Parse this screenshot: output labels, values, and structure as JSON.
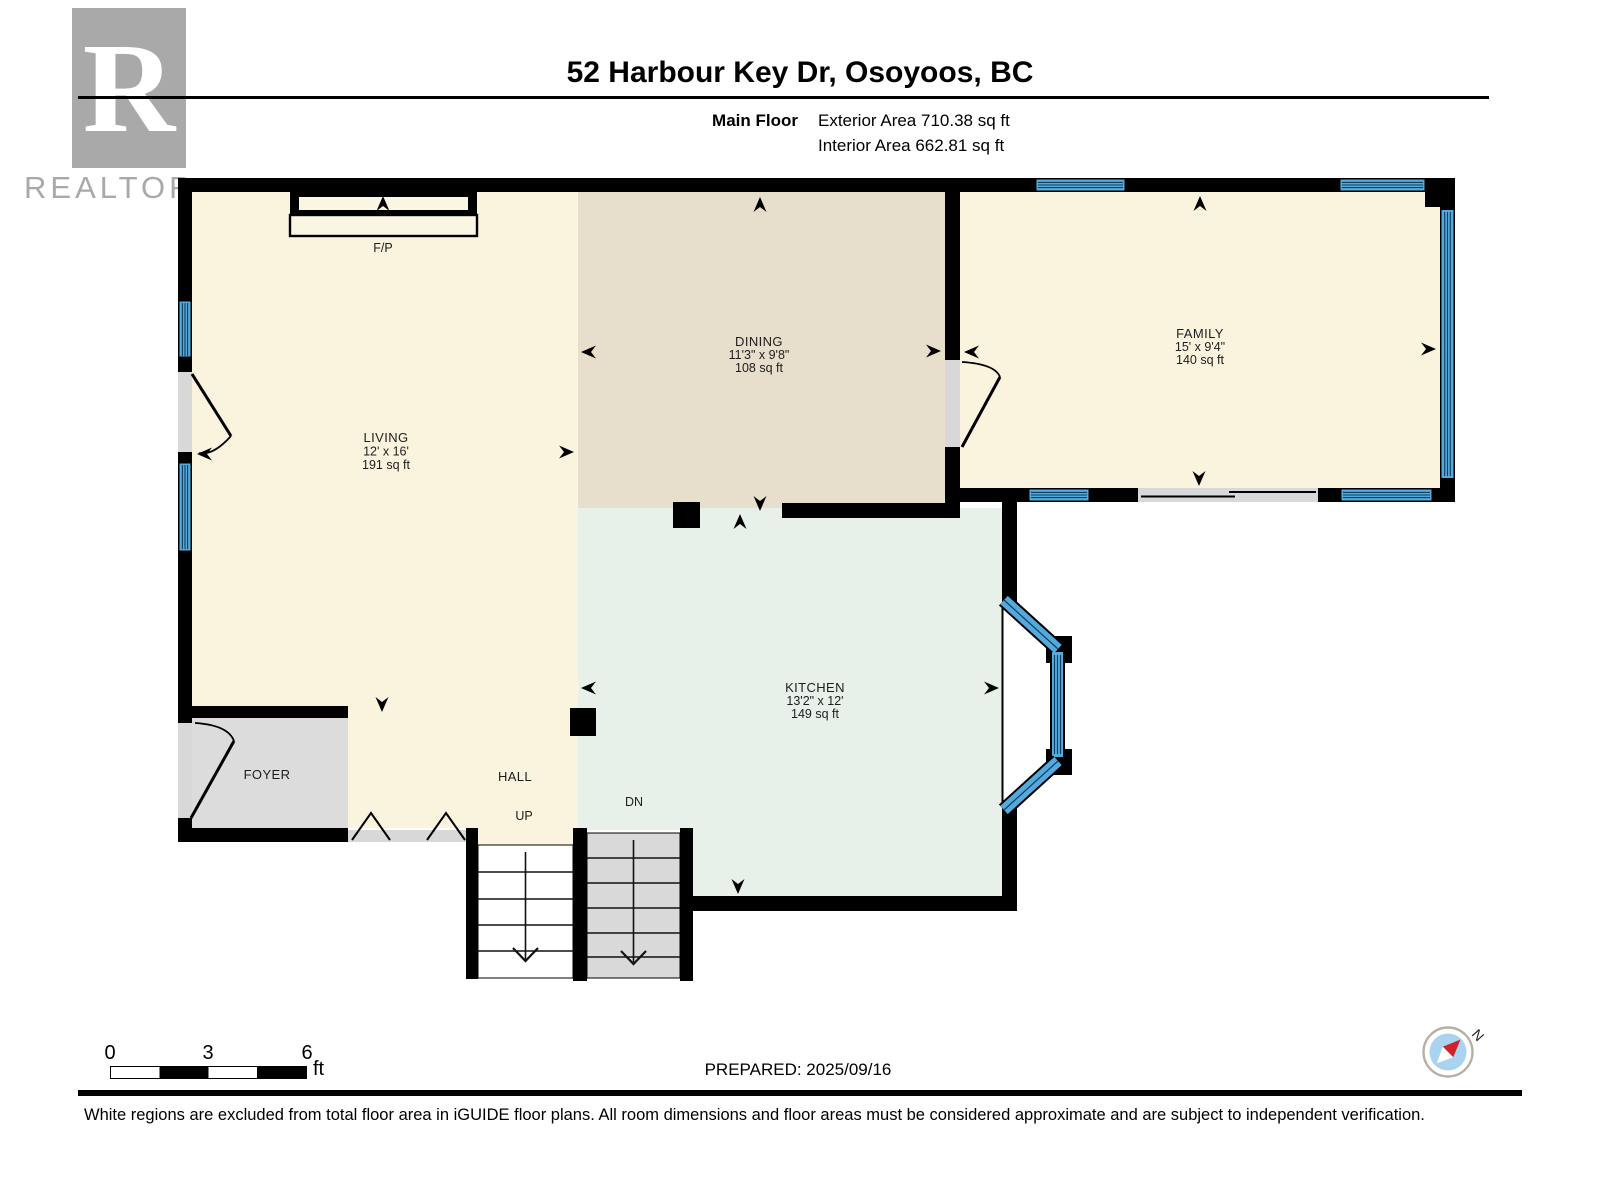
{
  "header": {
    "logo_letter": "R",
    "logo_text": "REALTOR",
    "logo_reg": "®",
    "title": "52 Harbour Key Dr, Osoyoos, BC",
    "floor_label": "Main Floor",
    "exterior_area": "Exterior Area 710.38 sq ft",
    "interior_area": "Interior Area 662.81 sq ft"
  },
  "rooms": {
    "living": {
      "name": "LIVING",
      "dims": "12' x 16'",
      "area": "191 sq ft"
    },
    "dining": {
      "name": "DINING",
      "dims": "11'3\" x 9'8\"",
      "area": "108 sq ft"
    },
    "family": {
      "name": "FAMILY",
      "dims": "15' x 9'4\"",
      "area": "140 sq ft"
    },
    "kitchen": {
      "name": "KITCHEN",
      "dims": "13'2\" x 12'",
      "area": "149 sq ft"
    },
    "foyer": {
      "name": "FOYER"
    },
    "hall": {
      "name": "HALL"
    }
  },
  "labels": {
    "fireplace": "F/P",
    "up": "UP",
    "down": "DN"
  },
  "footer": {
    "scale_0": "0",
    "scale_3": "3",
    "scale_6": "6",
    "scale_unit": "ft",
    "prepared": "PREPARED: 2025/09/16",
    "compass_north": "N",
    "disclaimer": "White regions are excluded from total floor area in iGUIDE floor plans. All room dimensions and floor areas must be considered approximate and are subject to independent verification."
  },
  "colors": {
    "wall": "#000000",
    "room_cream": "#faf3de",
    "room_tan": "#e7decb",
    "room_mint": "#e8f0ea",
    "room_gray": "#dcdcdc",
    "window_blue": "#54a9dd",
    "window_stripe": "#0f3d5c",
    "compass_blue": "#a9d3ef",
    "compass_red": "#d42127",
    "logo_gray": "#a9a9a9"
  }
}
